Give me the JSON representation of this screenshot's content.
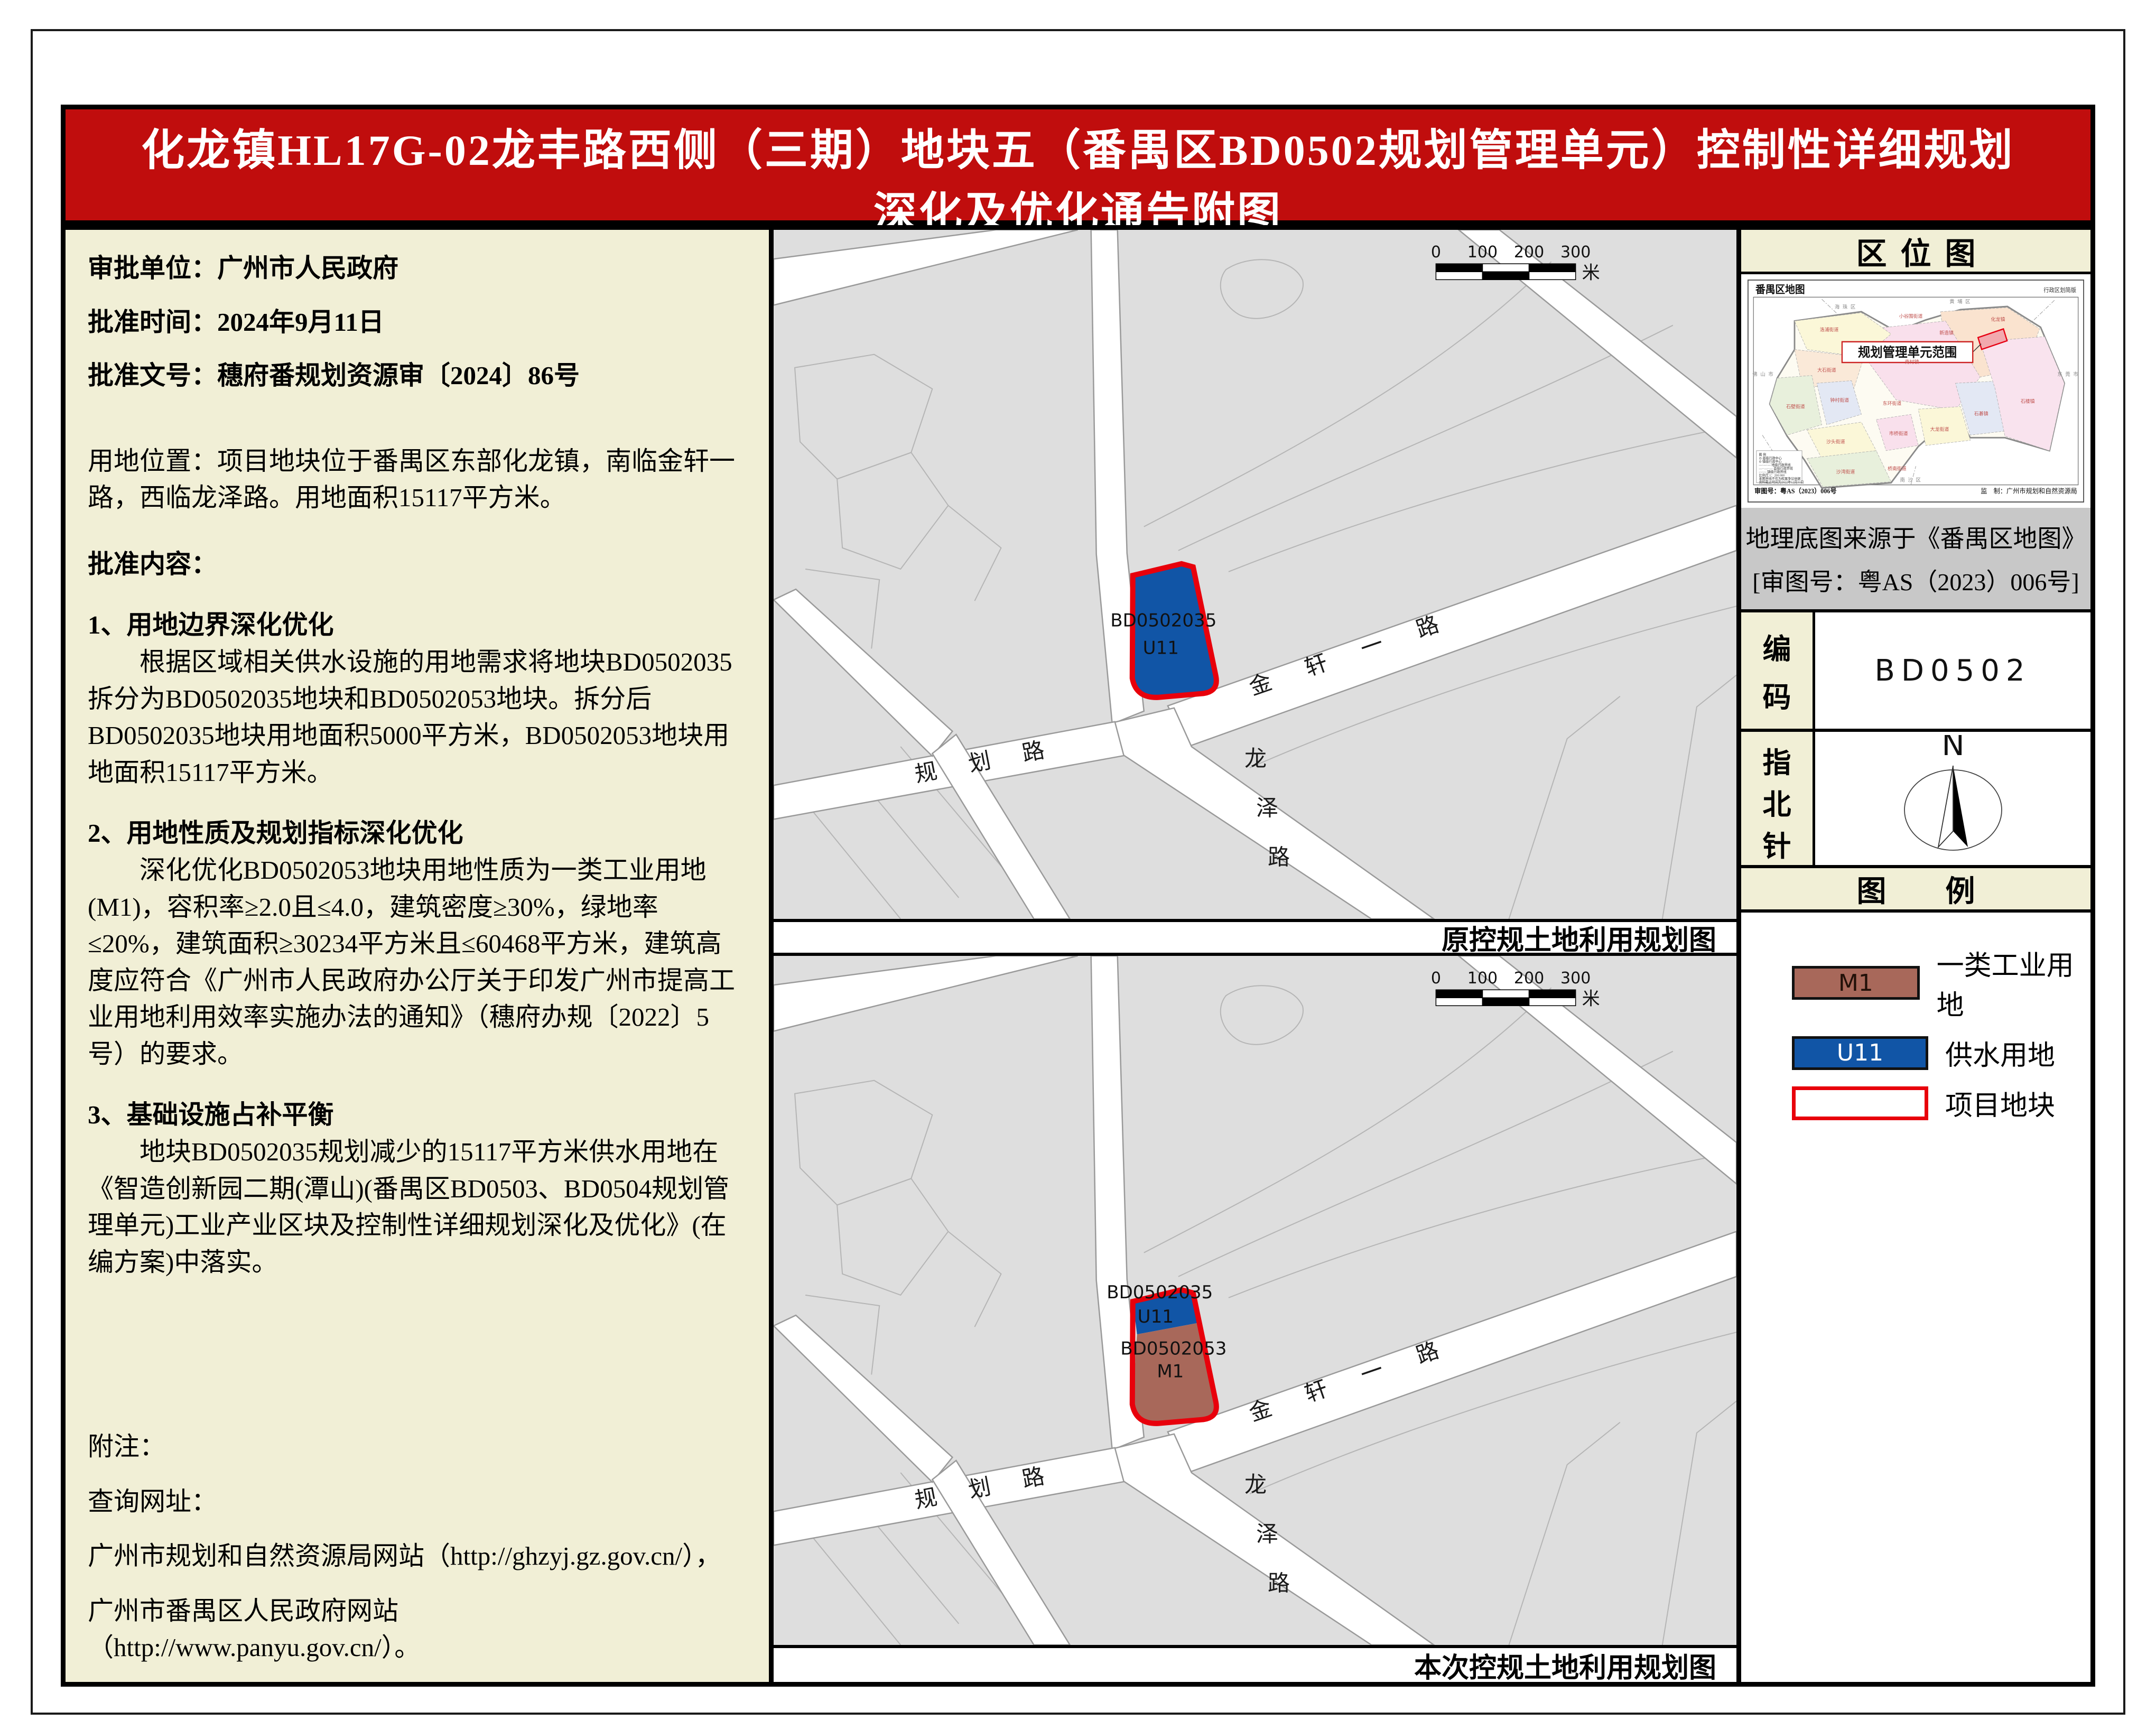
{
  "title": {
    "line1": "化龙镇HL17G-02龙丰路西侧（三期）地块五（番禺区BD0502规划管理单元）控制性详细规划",
    "line2": "深化及优化通告附图"
  },
  "left_panel": {
    "fields": [
      "审批单位：广州市人民政府",
      "批准时间：2024年9月11日",
      "批准文号：穗府番规划资源审〔2024〕86号"
    ],
    "location": "用地位置：项目地块位于番禺区东部化龙镇，南临金轩一路，西临龙泽路。用地面积15117平方米。",
    "content_heading": "批准内容：",
    "item1_heading": "1、用地边界深化优化",
    "item1_body": "根据区域相关供水设施的用地需求将地块BD0502035拆分为BD0502035地块和BD0502053地块。拆分后BD0502035地块用地面积5000平方米，BD0502053地块用地面积15117平方米。",
    "item2_heading": "2、用地性质及规划指标深化优化",
    "item2_body": "深化优化BD0502053地块用地性质为一类工业用地(M1)，容积率≥2.0且≤4.0，建筑密度≥30%，绿地率≤20%，建筑面积≥30234平方米且≤60468平方米，建筑高度应符合《广州市人民政府办公厅关于印发广州市提高工业用地利用效率实施办法的通知》（穗府办规〔2022〕5号）的要求。",
    "item3_heading": "3、基础设施占补平衡",
    "item3_body": "地块BD0502035规划减少的15117平方米供水用地在《智造创新园二期(潭山)(番禺区BD0503、BD0504规划管理单元)工业产业区块及控制性详细规划深化及优化》(在编方案)中落实。",
    "note_heading": "附注：",
    "query_heading": "查询网址：",
    "query_line1": "广州市规划和自然资源局网站（http://ghzyj.gz.gov.cn/），",
    "query_line2": "广州市番禺区人民政府网站　（http://www.panyu.gov.cn/）。"
  },
  "maps": {
    "scale": {
      "ticks": [
        "0",
        "100",
        "200",
        "300"
      ],
      "unit": "米"
    },
    "roads": {
      "jinxuan": "金 轩 一 路",
      "longze": [
        "龙",
        "泽",
        "路"
      ],
      "guihua": "规 划 路"
    },
    "top": {
      "caption": "原控规土地利用规划图",
      "parcels": [
        {
          "code": "BD0502035",
          "use": "U11"
        }
      ]
    },
    "bottom": {
      "caption": "本次控规土地利用规划图",
      "parcels": [
        {
          "code": "BD0502035",
          "use": "U11"
        },
        {
          "code": "BD0502053",
          "use": "M1"
        }
      ]
    }
  },
  "sidebar": {
    "location_map": {
      "header": "区位图",
      "map_title": "番禺区地图",
      "map_subtitle": "行政区划简版",
      "callout": "规划管理单元范围",
      "footer_left": "审图号：粤AS（2023）006号",
      "footer_right": "监　制：广州市规划和自然资源局",
      "district_labels": [
        "洛浦街道",
        "大石街道",
        "石壁街道",
        "钟村街道",
        "沙头街道",
        "沙湾街道",
        "市桥街道",
        "东环街道",
        "大龙街道",
        "桥南街道",
        "南村镇",
        "小谷围街道",
        "新造镇",
        "化龙镇",
        "石碁镇",
        "石楼镇"
      ],
      "neighbor_labels": [
        "海珠区",
        "黄埔区",
        "佛山市",
        "南沙区",
        "东莞市"
      ],
      "mini_legend_lines": [
        "图  例",
        "◎ 县级行政中心",
        "⊙ 镇级行政中心",
        "—·—·— 地级行政界线",
        "—··—··— 县级行政界线",
        "-·-·-·- 镇级行政界线",
        "比例尺 1：200 000",
        "本图界线不作为权属争议依据",
        "资料截止时间为2022年12月31日"
      ]
    },
    "geo_note": {
      "line1": "地理底图来源于《番禺区地图》",
      "line2": "[审图号：粤AS（2023）006号]"
    },
    "code": {
      "label_chars": [
        "编",
        "码"
      ],
      "value": "BD0502"
    },
    "compass": {
      "label_chars": [
        "指",
        "北",
        "针"
      ],
      "north": "N"
    },
    "legend": {
      "header": "图　　例",
      "items": [
        {
          "code": "M1",
          "label": "一类工业用地",
          "color": "#A8685A"
        },
        {
          "code": "U11",
          "label": "供水用地",
          "color": "#1155A6"
        },
        {
          "code": "",
          "label": "项目地块",
          "color": "#FFFFFF",
          "border": "#E8000B"
        }
      ]
    }
  },
  "colors": {
    "banner_red": "#C00D0D",
    "panel_cream": "#F1EFD6",
    "map_gray": "#DEDEDE",
    "m1_brown": "#A8685A",
    "u11_blue": "#1155A6",
    "site_red": "#E8000B",
    "note_gray": "#C8C8C8"
  }
}
